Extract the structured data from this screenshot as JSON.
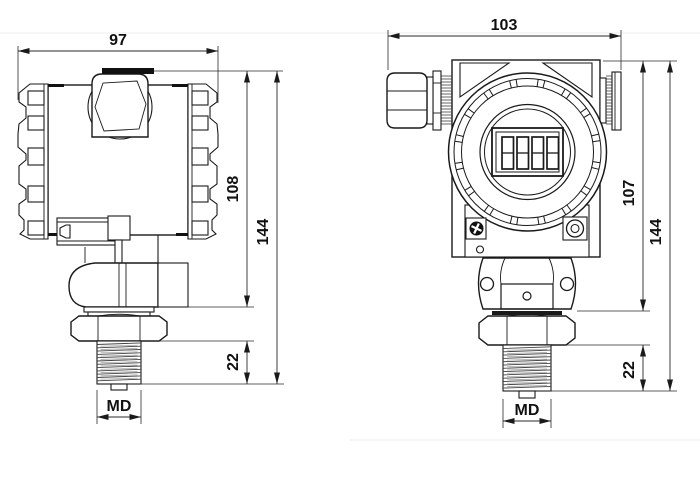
{
  "drawing": {
    "subject": "pressure-transmitter-dimensional-drawing",
    "colors": {
      "ink": "#1a1a1a",
      "paper": "#ffffff"
    },
    "left_view": {
      "label": "side-view",
      "dims": {
        "width": "97",
        "body_height": "108",
        "total_height": "144",
        "thread_length": "22",
        "thread_size": "MD"
      }
    },
    "right_view": {
      "label": "front-view",
      "dims": {
        "width": "103",
        "body_height": "107",
        "total_height": "144",
        "thread_length": "22",
        "thread_size": "MD"
      }
    }
  }
}
